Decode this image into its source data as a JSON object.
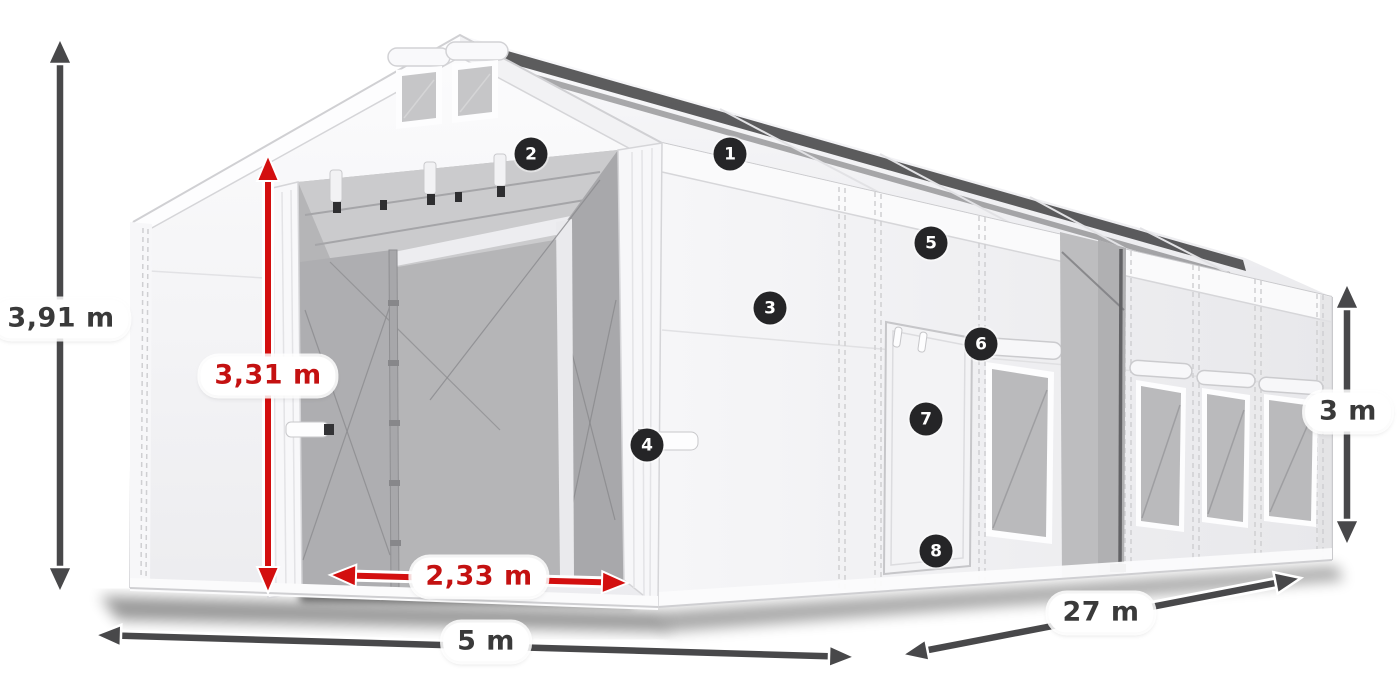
{
  "dimensions": {
    "overall_height": "3,91 m",
    "door_height": "3,31 m",
    "door_width": "2,33 m",
    "width": "5 m",
    "length": "27 m",
    "side_height": "3 m"
  },
  "callouts": {
    "labels": [
      "1",
      "2",
      "3",
      "4",
      "5",
      "6",
      "7",
      "8"
    ]
  },
  "colors": {
    "dimension_accent_red": "#d30f0f",
    "dimension_text_red": "#c41111",
    "arrow_gray": "#48484a",
    "badge_background": "#252527",
    "label_text": "#3a3a3a",
    "canvas_background": "#ffffff",
    "tent_white": "#f7f7f9",
    "mesh_gray": "#b5b5b7"
  }
}
